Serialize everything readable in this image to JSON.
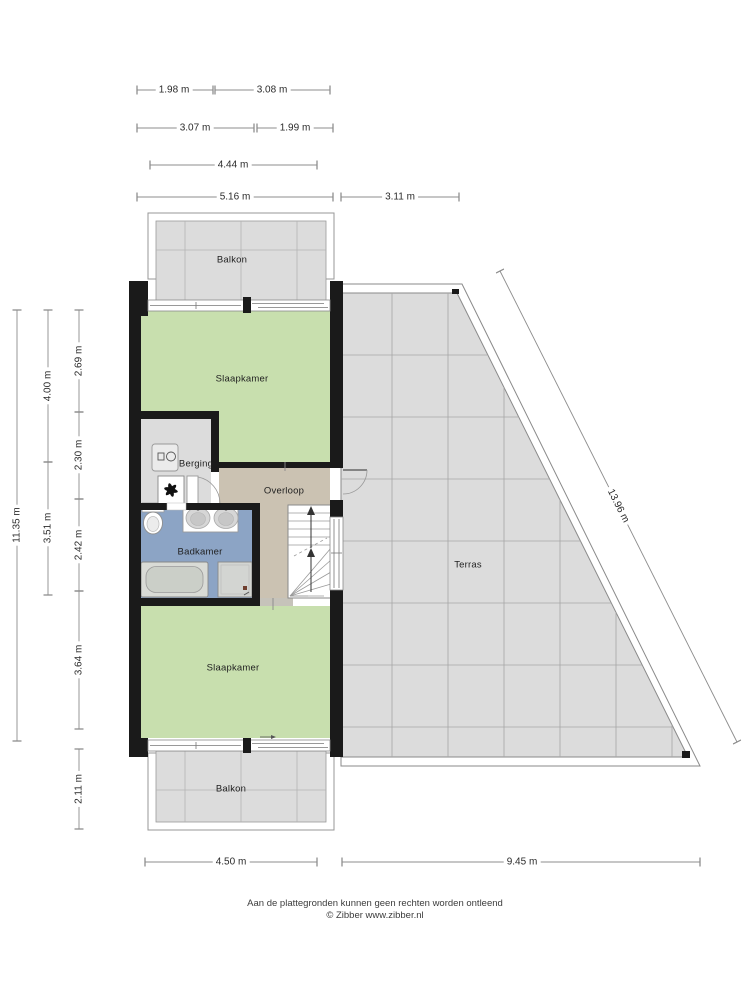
{
  "rooms": {
    "balkon_top": "Balkon",
    "slaapkamer_top": "Slaapkamer",
    "berging": "Berging",
    "overloop": "Overloop",
    "badkamer": "Badkamer",
    "slaapkamer_bottom": "Slaapkamer",
    "balkon_bottom": "Balkon",
    "terras": "Terras"
  },
  "dimensions": {
    "top_row1_left": "1.98 m",
    "top_row1_right": "3.08 m",
    "top_row2_left": "3.07 m",
    "top_row2_right": "1.99 m",
    "top_row3": "4.44 m",
    "top_row4_left": "5.16 m",
    "top_row4_right": "3.11 m",
    "left_total": "11.35 m",
    "left_mid_top": "4.00 m",
    "left_mid_bottom": "3.51 m",
    "left_inner_1": "2.69 m",
    "left_inner_2": "2.30 m",
    "left_inner_3": "2.42 m",
    "left_inner_4": "3.64 m",
    "left_inner_5": "2.11 m",
    "diagonal": "13.96 m",
    "bottom_left": "4.50 m",
    "bottom_right": "9.45 m"
  },
  "footer": {
    "disclaimer": "Aan de plattegronden kunnen geen rechten worden ontleend",
    "credit": "© Zibber www.zibber.nl"
  },
  "colors": {
    "wall": "#1a1a1a",
    "room_green": "#c8dfae",
    "bath_blue": "#8ca4c5",
    "landing_tan": "#cbc2b2",
    "floor_gray": "#dcdcdc",
    "grid_line": "#a6a6a6",
    "dim_line": "#8c8c8c"
  },
  "icons": {
    "washer": "washing-machine-icon",
    "fan": "ventilation-fan-icon",
    "stairs": "stairs-up-arrow-icon"
  }
}
